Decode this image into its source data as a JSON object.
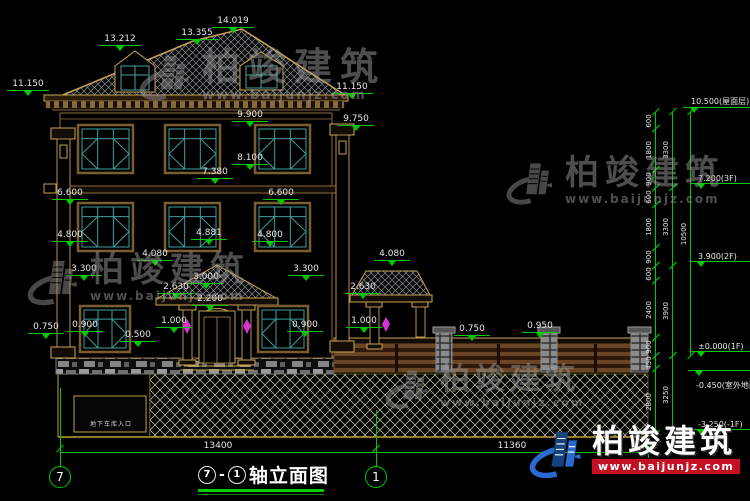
{
  "title": {
    "axis_start": "7",
    "sep": "-",
    "axis_end": "1",
    "name": "轴立面图",
    "full": "⑦-①轴立面图"
  },
  "garage_label": "地下车库入口",
  "watermark": {
    "company": "柏竣建筑",
    "url": "www.baijunjz.com"
  },
  "colors": {
    "dim_green": "#00c800",
    "trim_tan": "#c8a455",
    "wood_brown": "#8a6a3a",
    "window_teal": "#3f9e9e",
    "lamp_magenta": "#d833d8",
    "brand_red": "#c41022",
    "brand_blue_dark": "#16427e",
    "brand_blue": "#2a6ad0"
  },
  "dims": [
    {
      "t": "14.019",
      "x": 233,
      "y": 16
    },
    {
      "t": "13.355",
      "x": 197,
      "y": 28
    },
    {
      "t": "13.212",
      "x": 120,
      "y": 34
    },
    {
      "t": "11.150",
      "x": 28,
      "y": 79
    },
    {
      "t": "11.150",
      "x": 352,
      "y": 82
    },
    {
      "t": "9.900",
      "x": 250,
      "y": 110
    },
    {
      "t": "9.750",
      "x": 356,
      "y": 114
    },
    {
      "t": "8.100",
      "x": 250,
      "y": 153
    },
    {
      "t": "7.380",
      "x": 215,
      "y": 167
    },
    {
      "t": "6.600",
      "x": 70,
      "y": 188
    },
    {
      "t": "6.600",
      "x": 281,
      "y": 188
    },
    {
      "t": "4.800",
      "x": 70,
      "y": 230
    },
    {
      "t": "4.881",
      "x": 209,
      "y": 228
    },
    {
      "t": "4.800",
      "x": 270,
      "y": 230
    },
    {
      "t": "4.080",
      "x": 155,
      "y": 249
    },
    {
      "t": "4.080",
      "x": 392,
      "y": 249
    },
    {
      "t": "3.300",
      "x": 84,
      "y": 264
    },
    {
      "t": "3.300",
      "x": 306,
      "y": 264
    },
    {
      "t": "3.000",
      "x": 206,
      "y": 272
    },
    {
      "t": "2.630",
      "x": 176,
      "y": 282
    },
    {
      "t": "2.630",
      "x": 363,
      "y": 282
    },
    {
      "t": "2.200",
      "x": 210,
      "y": 294
    },
    {
      "t": "1.000",
      "x": 174,
      "y": 316
    },
    {
      "t": "1.000",
      "x": 364,
      "y": 316
    },
    {
      "t": "0.900",
      "x": 85,
      "y": 320
    },
    {
      "t": "0.900",
      "x": 305,
      "y": 320
    },
    {
      "t": "0.500",
      "x": 138,
      "y": 330
    },
    {
      "t": "0.750",
      "x": 46,
      "y": 322
    },
    {
      "t": "0.750",
      "x": 472,
      "y": 324
    },
    {
      "t": "0.950",
      "x": 540,
      "y": 321
    }
  ],
  "levels": [
    {
      "t": "10.500(屋面层)",
      "x": 683,
      "y": 107,
      "w": 67,
      "below": false
    },
    {
      "t": "7.200(3F)",
      "x": 690,
      "y": 185,
      "w": 60,
      "below": false
    },
    {
      "t": "3.900(2F)",
      "x": 690,
      "y": 263,
      "w": 60,
      "below": false
    },
    {
      "t": "±0.000(1F)",
      "x": 690,
      "y": 353,
      "w": 60,
      "below": false
    },
    {
      "t": "-0.450(室外地面)",
      "x": 688,
      "y": 370,
      "w": 62,
      "below": true
    },
    {
      "t": "-3.250(-1F)",
      "x": 690,
      "y": 431,
      "w": 60,
      "below": false
    }
  ],
  "vdims": [
    {
      "t": "600",
      "x": 655,
      "y1": 112,
      "y2": 129
    },
    {
      "t": "1800",
      "x": 655,
      "y1": 129,
      "y2": 170
    },
    {
      "t": "900",
      "x": 655,
      "y1": 170,
      "y2": 188
    },
    {
      "t": "600",
      "x": 655,
      "y1": 188,
      "y2": 205
    },
    {
      "t": "1800",
      "x": 655,
      "y1": 205,
      "y2": 248
    },
    {
      "t": "900",
      "x": 655,
      "y1": 248,
      "y2": 266
    },
    {
      "t": "600",
      "x": 655,
      "y1": 266,
      "y2": 281
    },
    {
      "t": "2400",
      "x": 655,
      "y1": 281,
      "y2": 338
    },
    {
      "t": "900",
      "x": 655,
      "y1": 338,
      "y2": 356
    },
    {
      "t": "450",
      "x": 655,
      "y1": 356,
      "y2": 369
    },
    {
      "t": "2800",
      "x": 655,
      "y1": 369,
      "y2": 434
    },
    {
      "t": "3300",
      "x": 672,
      "y1": 112,
      "y2": 188
    },
    {
      "t": "3300",
      "x": 672,
      "y1": 188,
      "y2": 266
    },
    {
      "t": "3900",
      "x": 672,
      "y1": 266,
      "y2": 356
    },
    {
      "t": "3250",
      "x": 672,
      "y1": 356,
      "y2": 434
    },
    {
      "t": "10500",
      "x": 690,
      "y1": 112,
      "y2": 356
    }
  ],
  "bottom_dims": [
    {
      "t": "13400",
      "x1": 60,
      "x2": 376,
      "y": 452
    },
    {
      "t": "11360",
      "x1": 376,
      "x2": 648,
      "y": 452
    }
  ],
  "axis_bubbles": [
    {
      "label": "7",
      "x": 60,
      "y": 477
    },
    {
      "label": "1",
      "x": 376,
      "y": 477
    }
  ]
}
